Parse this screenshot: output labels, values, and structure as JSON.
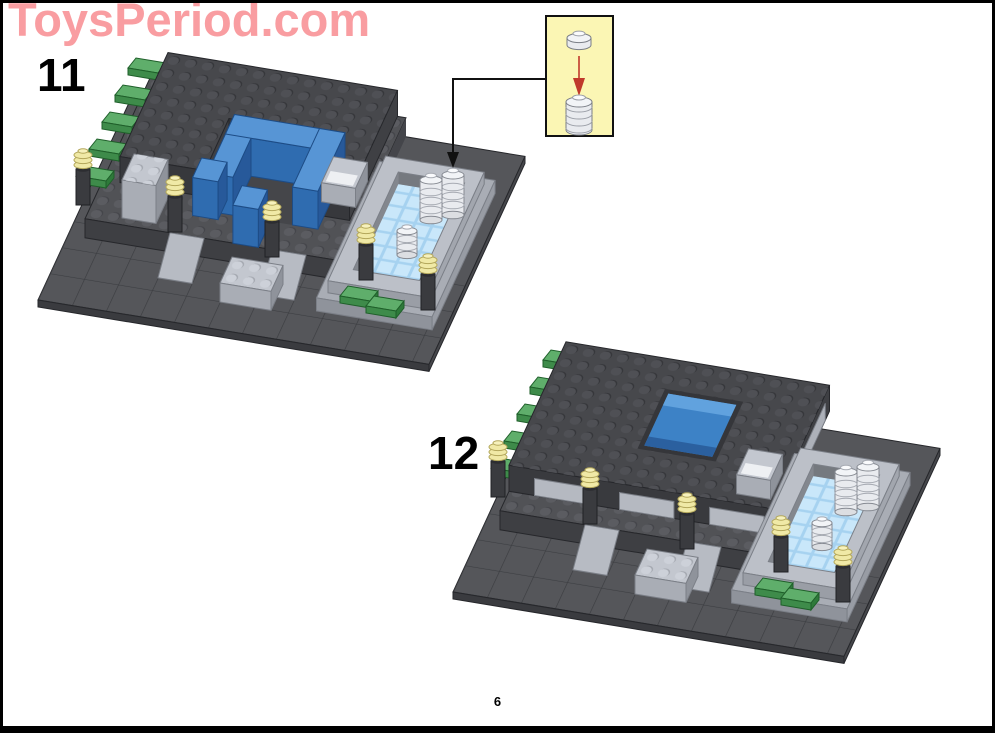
{
  "page": {
    "watermark": "ToysPeriod.com",
    "page_number": "6"
  },
  "steps": [
    {
      "number": "11"
    },
    {
      "number": "12"
    }
  ],
  "callout": {
    "pieces": [
      "white-round-plate-1x1",
      "stack-of-five-white-round-plates"
    ],
    "arrow": "red-down-arrow",
    "pointer": "black-elbow-connector-with-arrowhead"
  },
  "colors": {
    "watermark_pink": "#F99DA1",
    "callout_yellow": "#FBF6B4",
    "arrow_red": "#C0392B",
    "dark_gray_plate": "#47484C",
    "medium_gray_ground": "#55565A",
    "light_gray_brick": "#C3C7CF",
    "blue_brick": "#3D82C6",
    "green_plate": "#5FAE6B",
    "pale_yellow_stud": "#F0E9A6",
    "pillar_black": "#3A3B3F",
    "water_blue": "#A6D2F0",
    "white_piece": "#E9EBEF",
    "frame_black": "#000000",
    "paper_white": "#FFFFFF"
  }
}
